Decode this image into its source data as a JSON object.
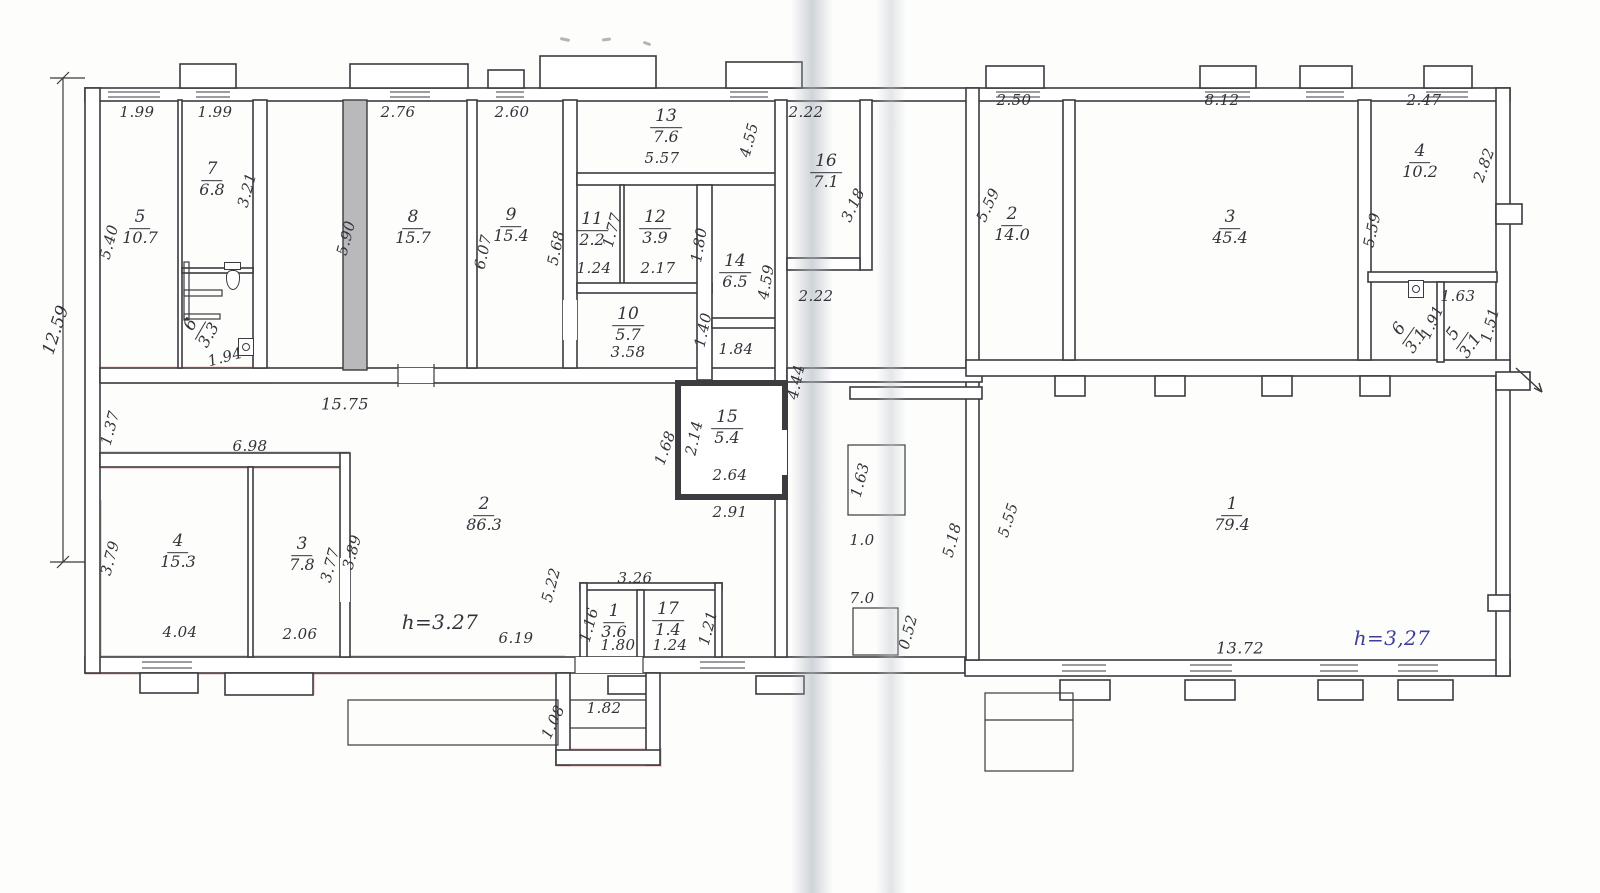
{
  "document": {
    "kind": "scanned hand-drawn floor plan",
    "height_note_left": "h=3.27",
    "height_note_right": "h=3,27"
  },
  "colors": {
    "ink": "#33333a",
    "blue_ink": "#3d3d9c",
    "paper": "#fdfdfc",
    "wall_stroke": "#3b3b40",
    "thick_wall_fill": "#b9b9bc",
    "red_tint": "#cd5c5c"
  },
  "rooms": [
    {
      "n": "5",
      "a": "10.7",
      "x": 140,
      "y": 228
    },
    {
      "n": "7",
      "a": "6.8",
      "x": 212,
      "y": 180
    },
    {
      "n": "6",
      "a": "3.3",
      "x": 200,
      "y": 330,
      "r": -60
    },
    {
      "n": "8",
      "a": "15.7",
      "x": 413,
      "y": 228
    },
    {
      "n": "9",
      "a": "15.4",
      "x": 511,
      "y": 226
    },
    {
      "n": "11",
      "a": "2.2",
      "x": 592,
      "y": 230
    },
    {
      "n": "12",
      "a": "3.9",
      "x": 655,
      "y": 228
    },
    {
      "n": "13",
      "a": "7.6",
      "x": 666,
      "y": 127
    },
    {
      "n": "10",
      "a": "5.7",
      "x": 628,
      "y": 325
    },
    {
      "n": "14",
      "a": "6.5",
      "x": 735,
      "y": 272
    },
    {
      "n": "15",
      "a": "5.4",
      "x": 727,
      "y": 428
    },
    {
      "n": "16",
      "a": "7.1",
      "x": 826,
      "y": 172
    },
    {
      "n": "2",
      "a": "86.3",
      "x": 484,
      "y": 515
    },
    {
      "n": "4",
      "a": "15.3",
      "x": 178,
      "y": 552
    },
    {
      "n": "3",
      "a": "7.8",
      "x": 302,
      "y": 555
    },
    {
      "n": "1",
      "a": "3.6",
      "x": 614,
      "y": 622
    },
    {
      "n": "17",
      "a": "1.4",
      "x": 668,
      "y": 620
    },
    {
      "n": "2",
      "a": "14.0",
      "x": 1012,
      "y": 225
    },
    {
      "n": "3",
      "a": "45.4",
      "x": 1230,
      "y": 228
    },
    {
      "n": "4",
      "a": "10.2",
      "x": 1420,
      "y": 162
    },
    {
      "n": "6",
      "a": "3.1",
      "x": 1408,
      "y": 335,
      "r": -55
    },
    {
      "n": "5",
      "a": "3.1",
      "x": 1462,
      "y": 340,
      "r": -55
    },
    {
      "n": "1",
      "a": "79.4",
      "x": 1232,
      "y": 515
    }
  ],
  "dimensions": [
    {
      "t": "1.99",
      "x": 137,
      "y": 112
    },
    {
      "t": "1.99",
      "x": 215,
      "y": 112
    },
    {
      "t": "2.76",
      "x": 398,
      "y": 112
    },
    {
      "t": "2.60",
      "x": 512,
      "y": 112
    },
    {
      "t": "2.22",
      "x": 806,
      "y": 112
    },
    {
      "t": "2.50",
      "x": 1014,
      "y": 100
    },
    {
      "t": "8.12",
      "x": 1222,
      "y": 100
    },
    {
      "t": "2.47",
      "x": 1424,
      "y": 100
    },
    {
      "t": "5.57",
      "x": 662,
      "y": 158
    },
    {
      "t": "12.59",
      "x": 56,
      "y": 330,
      "r": -72,
      "s": 17
    },
    {
      "t": "5.40",
      "x": 109,
      "y": 242,
      "r": -75
    },
    {
      "t": "3.21",
      "x": 247,
      "y": 190,
      "r": -75
    },
    {
      "t": "5.90",
      "x": 346,
      "y": 238,
      "r": -75
    },
    {
      "t": "6.07",
      "x": 483,
      "y": 252,
      "r": -78
    },
    {
      "t": "5.68",
      "x": 556,
      "y": 248,
      "r": -78
    },
    {
      "t": "1.77",
      "x": 612,
      "y": 230,
      "r": -75
    },
    {
      "t": "1.80",
      "x": 699,
      "y": 245,
      "r": -80
    },
    {
      "t": "4.55",
      "x": 749,
      "y": 140,
      "r": -75
    },
    {
      "t": "4.59",
      "x": 766,
      "y": 282,
      "r": -80
    },
    {
      "t": "3.18",
      "x": 853,
      "y": 205,
      "r": -65
    },
    {
      "t": "4.44",
      "x": 796,
      "y": 382,
      "r": -78
    },
    {
      "t": "1.24",
      "x": 594,
      "y": 268
    },
    {
      "t": "2.17",
      "x": 658,
      "y": 268
    },
    {
      "t": "3.58",
      "x": 628,
      "y": 352
    },
    {
      "t": "1.40",
      "x": 703,
      "y": 330,
      "r": -78
    },
    {
      "t": "1.84",
      "x": 736,
      "y": 349
    },
    {
      "t": "2.22",
      "x": 816,
      "y": 296
    },
    {
      "t": "15.75",
      "x": 345,
      "y": 404,
      "s": 16
    },
    {
      "t": "1.37",
      "x": 110,
      "y": 428,
      "r": -75
    },
    {
      "t": "6.98",
      "x": 250,
      "y": 446
    },
    {
      "t": "1.94",
      "x": 225,
      "y": 357,
      "r": -15
    },
    {
      "t": "1.68",
      "x": 665,
      "y": 448,
      "r": -70
    },
    {
      "t": "2.14",
      "x": 694,
      "y": 438,
      "r": -78
    },
    {
      "t": "2.64",
      "x": 730,
      "y": 475
    },
    {
      "t": "2.91",
      "x": 730,
      "y": 512
    },
    {
      "t": "1.63",
      "x": 860,
      "y": 480,
      "r": -75
    },
    {
      "t": "1.0",
      "x": 862,
      "y": 540
    },
    {
      "t": "7.0",
      "x": 862,
      "y": 598
    },
    {
      "t": "0.52",
      "x": 908,
      "y": 632,
      "r": -75
    },
    {
      "t": "5.18",
      "x": 952,
      "y": 540,
      "r": -75
    },
    {
      "t": "5.55",
      "x": 1008,
      "y": 520,
      "r": -72
    },
    {
      "t": "5.59",
      "x": 988,
      "y": 205,
      "r": -65
    },
    {
      "t": "5.59",
      "x": 1372,
      "y": 230,
      "r": -78
    },
    {
      "t": "2.82",
      "x": 1484,
      "y": 165,
      "r": -70
    },
    {
      "t": "1.63",
      "x": 1458,
      "y": 296
    },
    {
      "t": "1.91",
      "x": 1432,
      "y": 322,
      "r": -65
    },
    {
      "t": "1.51",
      "x": 1490,
      "y": 325,
      "r": -75
    },
    {
      "t": "3.79",
      "x": 110,
      "y": 558,
      "r": -75
    },
    {
      "t": "4.04",
      "x": 180,
      "y": 632
    },
    {
      "t": "2.06",
      "x": 300,
      "y": 634
    },
    {
      "t": "3.77",
      "x": 330,
      "y": 565,
      "r": -75
    },
    {
      "t": "3.89",
      "x": 352,
      "y": 552,
      "r": -75
    },
    {
      "t": "6.19",
      "x": 516,
      "y": 638
    },
    {
      "t": "5.22",
      "x": 551,
      "y": 585,
      "r": -75
    },
    {
      "t": "3.26",
      "x": 635,
      "y": 578
    },
    {
      "t": "1.16",
      "x": 589,
      "y": 625,
      "r": -75
    },
    {
      "t": "1.80",
      "x": 618,
      "y": 645
    },
    {
      "t": "1.24",
      "x": 670,
      "y": 645
    },
    {
      "t": "1.21",
      "x": 708,
      "y": 628,
      "r": -75
    },
    {
      "t": "1.82",
      "x": 604,
      "y": 708
    },
    {
      "t": "1.08",
      "x": 553,
      "y": 722,
      "r": -65
    },
    {
      "t": "13.72",
      "x": 1240,
      "y": 648,
      "s": 16
    }
  ],
  "notes": [
    {
      "t": "h=3.27",
      "x": 440,
      "y": 622,
      "s": 20,
      "c": "#33333a"
    },
    {
      "t": "h=3,27",
      "x": 1392,
      "y": 638,
      "s": 20,
      "c": "#3d3d9c"
    }
  ],
  "fixtures": [
    {
      "icon": "toilet",
      "x": 226,
      "y": 270,
      "r": 0
    },
    {
      "icon": "sink",
      "x": 238,
      "y": 338,
      "r": 0
    },
    {
      "icon": "sink",
      "x": 1408,
      "y": 280,
      "r": 0
    }
  ]
}
